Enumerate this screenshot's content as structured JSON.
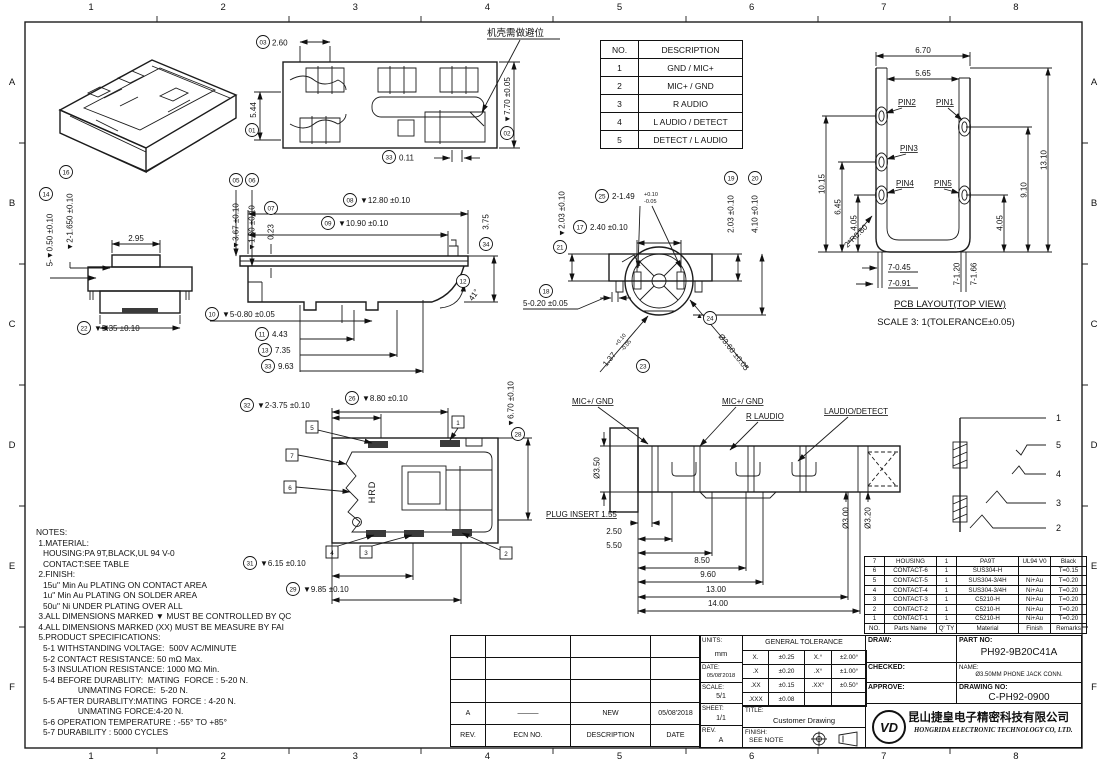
{
  "sheet": {
    "zone_cols": [
      "1",
      "2",
      "3",
      "4",
      "5",
      "6",
      "7",
      "8"
    ],
    "zone_rows": [
      "A",
      "B",
      "C",
      "D",
      "E",
      "F"
    ]
  },
  "pin_table": {
    "rows": [
      [
        "NO.",
        "DESCRIPTION"
      ],
      [
        "1",
        "GND / MIC+"
      ],
      [
        "2",
        "MIC+ / GND"
      ],
      [
        "3",
        "R AUDIO"
      ],
      [
        "4",
        "L AUDIO / DETECT"
      ],
      [
        "5",
        "DETECT / L AUDIO"
      ]
    ]
  },
  "top_view": {
    "note_cn": "机壳需做避位",
    "b03": "03",
    "d03": "2.60",
    "b01": "01",
    "d01": "5.44",
    "b02": "02",
    "d02": "▼7.70 ±0.05",
    "b33": "33",
    "d33": "0.11"
  },
  "side_view": {
    "b05": "05",
    "d05": "▼3.67 ±0.10",
    "b06": "06",
    "d06": "▼1.80 ±0.10",
    "b07": "07",
    "d07": "0.23",
    "b08": "08",
    "d08": "▼12.80 ±0.10",
    "b09": "09",
    "d09": "▼10.90 ±0.10",
    "b10": "10",
    "d10": "▼5-0.80 ±0.05",
    "b11": "11",
    "d11": "4.43",
    "b13": "13",
    "d13": "7.35",
    "b33": "33",
    "d33": "9.63",
    "b12": "12",
    "d12": "41°",
    "b34": "34",
    "d34": "3.75"
  },
  "end_view": {
    "b14": "14",
    "d14": "5-▼0.50 ±0.10",
    "b16": "16",
    "d16": "▼2-1.650 ±0.10",
    "d295": "2.95",
    "b22": "22",
    "d22": "▼5.35 ±0.10"
  },
  "front_view": {
    "b25": "25",
    "d25": "2-1.49",
    "d25_sup": "+0.10",
    "d25_sub": "-0.05",
    "b17": "17",
    "d17": "2.40 ±0.10",
    "b21": "21",
    "d21": "▼2.03 ±0.10",
    "b19": "19",
    "d19": "2.03 ±0.10",
    "b20": "20",
    "d20": "4.10 ±0.10",
    "b18": "18",
    "d18": "5-0.20 ±0.05",
    "b23": "23",
    "d23": "1.37",
    "d23_sup": "+0.10",
    "d23_sub": "-0.05",
    "b24": "24",
    "d24": "Ø3.60 ±0.05",
    "qc_mark": "▲"
  },
  "bottom_view": {
    "b26": "26",
    "d26": "▼8.80 ±0.10",
    "b32": "32",
    "d32": "▼2-3.75 ±0.10",
    "b28": "28",
    "d28": "▼6.70 ±0.10",
    "b31": "31",
    "d31": "▼6.15 ±0.10",
    "b29": "29",
    "d29": "▼9.85 ±0.10",
    "c1": "1",
    "c2": "2",
    "c3": "3",
    "c4": "4",
    "c5": "5",
    "c6": "6",
    "c7": "7",
    "marking": "HRD"
  },
  "plug_view": {
    "lbl1": "MIC+/ GND",
    "lbl2": "MIC+/ GND",
    "lbl3": "R LAUDIO",
    "lbl4": "LAUDIO/DETECT",
    "dia_plug": "Ø3.50",
    "insert": "PLUG INSERT 1.55",
    "d1": "2.50",
    "d2": "5.50",
    "d3": "8.50",
    "d4": "9.60",
    "d5": "13.00",
    "d6": "14.00",
    "dia1": "Ø3.00",
    "dia2": "Ø3.20"
  },
  "schematic": {
    "p1": "1",
    "p2": "5",
    "p3": "4",
    "p4": "3",
    "p5": "2"
  },
  "pcb": {
    "title": "PCB LAYOUT(TOP VIEW)",
    "scale_note": "SCALE 3: 1(TOLERANCE±0.05)",
    "pin1": "PIN1",
    "pin2": "PIN2",
    "pin3": "PIN3",
    "pin4": "PIN4",
    "pin5": "PIN5",
    "d670": "6.70",
    "d565": "5.65",
    "d1015": "10.15",
    "d645": "6.45",
    "d405l": "4.05",
    "d910": "9.10",
    "d1310": "13.10",
    "d405r": "4.05",
    "r080": "2*R0.80",
    "d7045": "7-0.45",
    "d7091": "7-0.91",
    "d7120": "7-1.20",
    "d7166": "7-1.66"
  },
  "notes": {
    "lines": [
      "NOTES:",
      " 1.MATERIAL:",
      "   HOUSING:PA 9T,BLACK,UL 94 V-0",
      "   CONTACT:SEE TABLE",
      " 2.FINISH:",
      "   15u\" Min Au PLATING ON CONTACT AREA",
      "   1u\" Min Au PLATING ON SOLDER AREA",
      "   50u\" Ni UNDER PLATING OVER ALL",
      " 3.ALL DIMENSIONS MARKED ▼ MUST BE CONTROLLED BY QC",
      " 4.ALL DIMENSIONS MARKED (XX) MUST BE MEASURE BY FAI",
      " 5.PRODUCT SPECIFICATIONS:",
      "   5-1 WITHSTANDING VOLTAGE:  500V AC/MINUTE",
      "   5-2 CONTACT RESISTANCE: 50 mΩ Max.",
      "   5-3 INSULATION RESISTANCE: 1000 MΩ Min.",
      "   5-4 BEFORE DURABLITY:  MATING  FORCE : 5-20 N.",
      "                  UNMATING FORCE:  5-20 N.",
      "   5-5 AFTER DURABLITY:MATING  FORCE : 4-20 N.",
      "                  UNMATING FORCE:4-20 N.",
      "   5-6 OPERATION TEMPERATURE : -55° TO +85°",
      "   5-7 DURABILITY : 5000 CYCLES"
    ]
  },
  "bom": {
    "rows": [
      [
        "7",
        "HOUSING",
        "1",
        "PA9T",
        "UL94 V0",
        "Black"
      ],
      [
        "6",
        "CONTACT-6",
        "1",
        "SUS304-H",
        "",
        "T=0.15"
      ],
      [
        "5",
        "CONTACT-5",
        "1",
        "SUS304-3/4H",
        "Ni+Au",
        "T=0.20"
      ],
      [
        "4",
        "CONTACT-4",
        "1",
        "SUS304-3/4H",
        "Ni+Au",
        "T=0.20"
      ],
      [
        "3",
        "CONTACT-3",
        "1",
        "C5210-H",
        "Ni+Au",
        "T=0.20"
      ],
      [
        "2",
        "CONTACT-2",
        "1",
        "C5210-H",
        "Ni+Au",
        "T=0.20"
      ],
      [
        "1",
        "CONTACT-1",
        "1",
        "C5210-H",
        "Ni+Au",
        "T=0.20"
      ],
      [
        "NO.",
        "Parts Name",
        "Q' TY",
        "Material",
        "Finish",
        "Remarks"
      ]
    ]
  },
  "title_block": {
    "rev_rows": [
      [
        "",
        "",
        "",
        ""
      ],
      [
        "",
        "",
        "",
        ""
      ],
      [
        "",
        "",
        "",
        ""
      ],
      [
        "A",
        "———",
        "NEW",
        "05/08'2018"
      ],
      [
        "REV.",
        "ECN NO.",
        "DESCRIPTION",
        "DATE"
      ]
    ],
    "units_label": "UNITS:",
    "units_value": "mm",
    "date_label": "DATE:",
    "date_value": "05/08'2018",
    "scale_label": "SCALE:",
    "scale_value": "5/1",
    "sheet_label": "SHEET:",
    "sheet_value": "1/1",
    "rev_label": "REV.",
    "rev_value": "A",
    "tol_title": "GENERAL TOLERANCE",
    "tol_rows": [
      [
        "X.",
        "±0.25",
        "X.°",
        "±2.00°"
      ],
      [
        ".X",
        "±0.20",
        ".X°",
        "±1.00°"
      ],
      [
        ".XX",
        "±0.15",
        ".XX°",
        "±0.50°"
      ],
      [
        ".XXX",
        "±0.08",
        "",
        ""
      ]
    ],
    "title_label": "TITLE:",
    "title_value": "Customer Drawing",
    "finish_label": "FINISH:",
    "finish_value": "SEE NOTE",
    "draw_label": "DRAW:",
    "checked_label": "CHECKED:",
    "approve_label": "APPROVE:",
    "part_no_label": "PART NO:",
    "part_no": "PH92-9B20C41A",
    "name_label": "NAME:",
    "name_value": "Ø3.50MM PHONE JACK CONN.",
    "drawing_no_label": "DRAWING NO:",
    "drawing_no": "C-PH92-0900",
    "company_cn": "昆山捷皇电子精密科技有限公司",
    "company_en": "HONGRIDA ELECTRONIC TECHNOLOGY CO, LTD.",
    "logo_text": "VD"
  }
}
